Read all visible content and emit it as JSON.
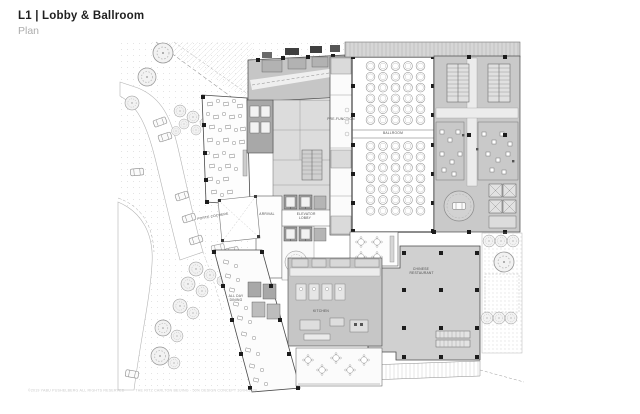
{
  "header": {
    "title": "L1 | Lobby & Ballroom",
    "subtitle": "Plan"
  },
  "plan": {
    "labels": {
      "ballroom": "BALLROOM",
      "pre_function": "PRE-FUNCTION",
      "elevator_lobby": "ELEVATOR LOBBY",
      "arrival": "ARRIVAL",
      "porte_cochere": "PORTE COCHERE",
      "all_day_dining": "ALL DAY DINING",
      "chinese_restaurant": "CHINESE RESTAURANT",
      "kitchen": "KITCHEN"
    }
  },
  "footer": {
    "copyright": "©2019 YABU PUSHELBERG ALL RIGHTS RESERVED",
    "project": "THE RITZ CARLTON BEIJING - 50% DESIGN CONCEPT 30/04/2020"
  },
  "colors": {
    "ink": "#3d3d3d",
    "boh_gray": "#c9c9c9",
    "light_gray": "#dcdcdc",
    "site_dot": "#bbbbbb",
    "label_text": "#4c4c4c",
    "muted_text": "#adadad",
    "faint_text": "#c9c9c9"
  }
}
